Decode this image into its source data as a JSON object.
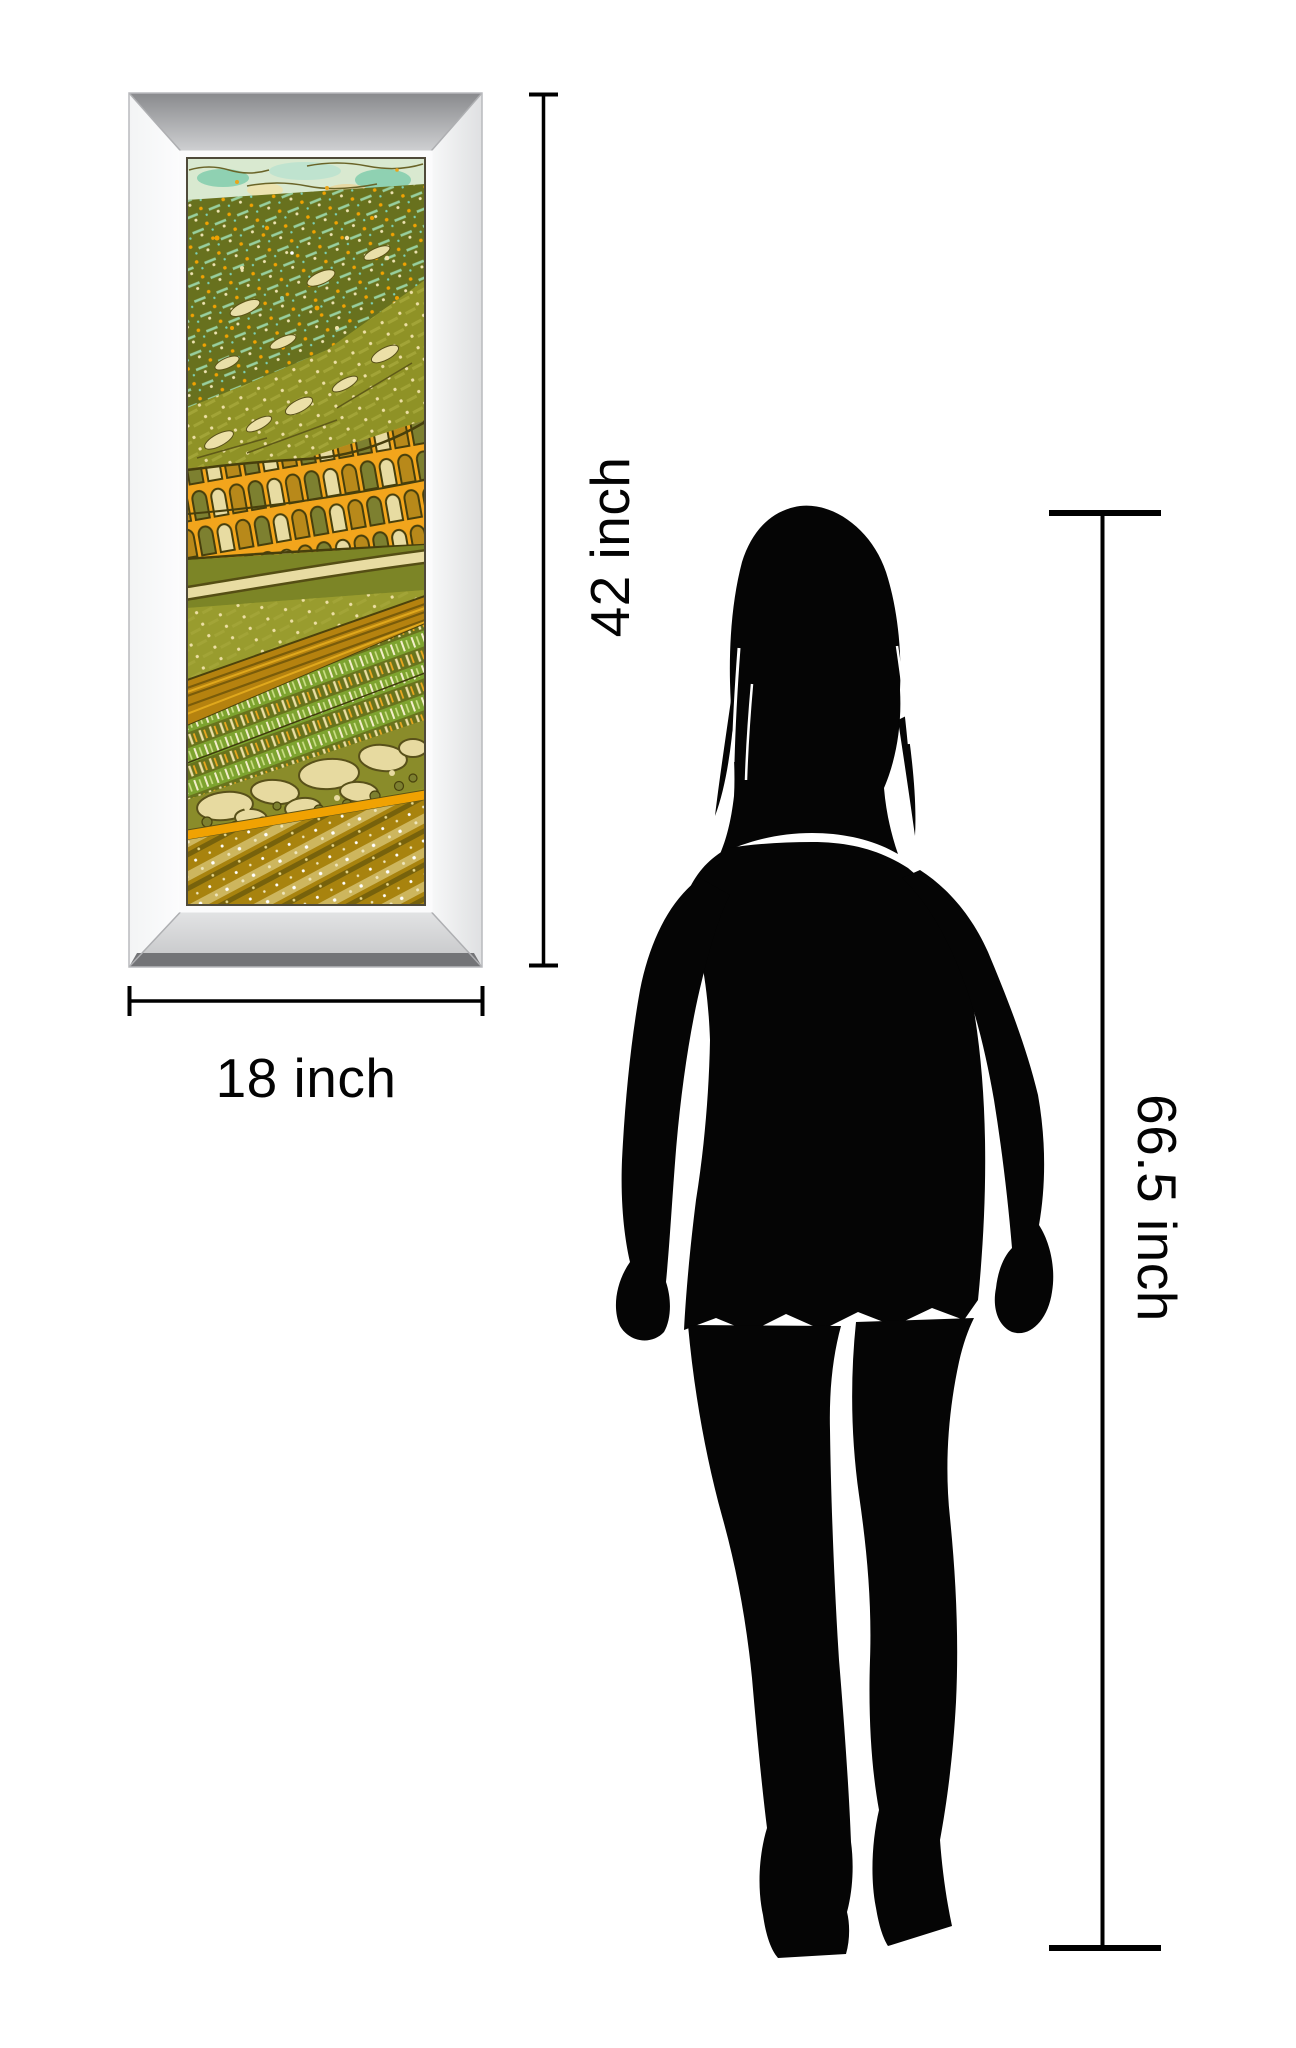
{
  "labels": {
    "art_height": "42 inch",
    "art_width": "18 inch",
    "person_height": "66.5 inch"
  },
  "measurements": {
    "artwork_height_inches": 42,
    "artwork_width_inches": 18,
    "person_height_inches": 66.5,
    "unit": "inch"
  },
  "icons": {
    "figure": "woman-silhouette-icon",
    "artwork": "framed-batik-landscape-art"
  },
  "colors": {
    "background": "#ffffff",
    "dimension_lines": "#000000",
    "label_text": "#030303",
    "silhouette": "#050505",
    "frame_silver_light": "#f5f6f7",
    "frame_silver_mid": "#c9cacc",
    "frame_silver_dark": "#8e8f92",
    "art_sky": "#d9e9d0",
    "art_teal": "#8fd1b2",
    "art_olive_dark": "#68711e",
    "art_olive": "#8f9226",
    "art_green": "#7da32f",
    "art_orange": "#f0a202",
    "art_gold": "#a8830e",
    "art_cream": "#e8dca2",
    "art_outline": "#473f0c"
  }
}
